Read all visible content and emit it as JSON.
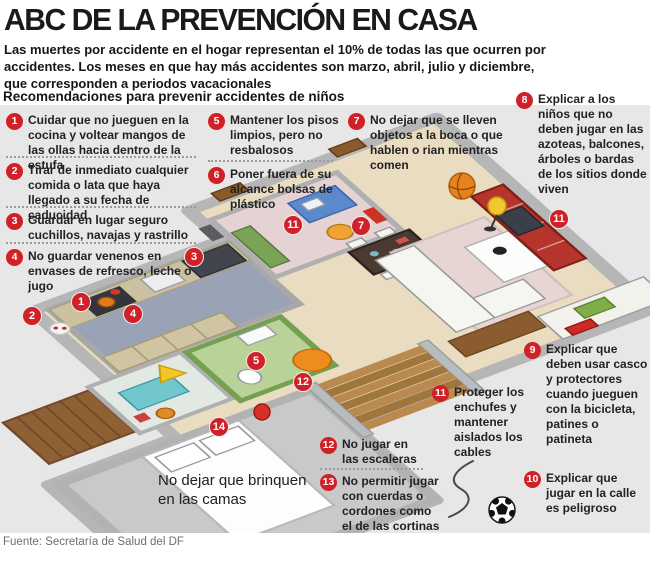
{
  "title": "ABC DE LA PREVENCIÓN EN CASA",
  "intro": "Las muertes por accidente en el hogar representan el 10% de todas las que ocurren por accidentes. Los meses en que hay más accidentes son marzo, abril, julio y diciembre, que corresponden a periodos vacacionales",
  "recommendations_heading": "Recomendaciones para  prevenir accidentes de  niños",
  "items": [
    {
      "n": "1",
      "text": "Cuidar que no jueguen en la cocina y voltear mangos de las ollas hacia dentro de la estufa"
    },
    {
      "n": "2",
      "text": "Tirar de inmediato cualquier comida o lata que haya llegado a su fecha de caducidad"
    },
    {
      "n": "3",
      "text": "Guardar en lugar seguro cuchillos, navajas y rastrillo"
    },
    {
      "n": "4",
      "text": "No guardar venenos en envases de refresco, leche o jugo"
    },
    {
      "n": "5",
      "text": "Mantener los pisos limpios, pero no resbalosos"
    },
    {
      "n": "6",
      "text": "Poner fuera de su alcance bolsas de plástico"
    },
    {
      "n": "7",
      "text": "No dejar que se lleven objetos a la boca o que hablen o rian mientras comen"
    },
    {
      "n": "8",
      "text": "Explicar a los niños que no deben jugar en las azoteas, balcones, árboles o bardas de los sitios donde viven"
    },
    {
      "n": "9",
      "text": "Explicar que deben usar casco y protectores cuando jueguen con la bicicleta, patines o patineta"
    },
    {
      "n": "10",
      "text": "Explicar que jugar en la calle es peligroso"
    },
    {
      "n": "11",
      "text": "Proteger los enchufes y mantener aislados los cables"
    },
    {
      "n": "12",
      "text": "No jugar en las escaleras"
    },
    {
      "n": "13",
      "text": "No permitir jugar con cuerdas o cordones como el de las cortinas"
    }
  ],
  "map_badges": [
    {
      "n": "1"
    },
    {
      "n": "2"
    },
    {
      "n": "3"
    },
    {
      "n": "4"
    },
    {
      "n": "5"
    },
    {
      "n": "7"
    },
    {
      "n": "11"
    },
    {
      "n": "11"
    },
    {
      "n": "12"
    },
    {
      "n": "14"
    }
  ],
  "bed_note": "No dejar que brinquen en las camas",
  "footer": {
    "source": "Fuente: Secretaría de Salud del DF"
  },
  "colors": {
    "badge_red": "#cf2127",
    "panel_gray": "#e7e7e7",
    "floor_beige": "#e9dcc0",
    "kitchen_blue": "#9aa2b6",
    "bath_green": "#b9d297",
    "tv_red": "#b5352c",
    "accent_orange": "#e8821c"
  }
}
